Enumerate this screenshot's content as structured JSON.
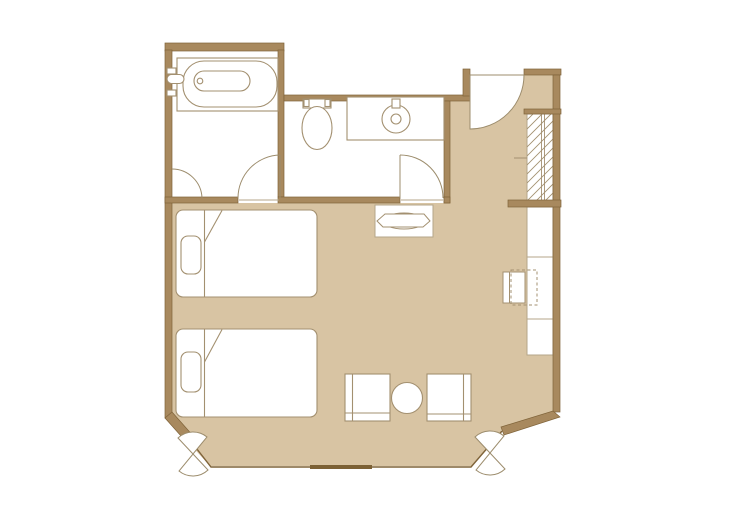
{
  "plan": {
    "name": "hotel-twin-room-floor-plan",
    "colors": {
      "background": "#ffffff",
      "floor": "#d8c4a3",
      "wall": "#a8895e",
      "wall_edge": "#7f6339",
      "fixture_line": "#a39070",
      "light_line": "#b5a689",
      "door_line": "#9c8c6c",
      "window_bar": "#7c6135",
      "white": "#ffffff"
    },
    "rooms": [
      {
        "name": "bathroom"
      },
      {
        "name": "toilet-washroom"
      },
      {
        "name": "entry-hall"
      },
      {
        "name": "closet"
      },
      {
        "name": "bedroom-living-area"
      }
    ],
    "furniture": [
      "bathtub",
      "bath-faucet",
      "toilet",
      "washbasin-counter",
      "round-sink",
      "luggage-bench",
      "closet-hanger-rail",
      "desk-counter",
      "desk-chair",
      "twin-bed-1",
      "twin-bed-2",
      "pillow-1",
      "pillow-2",
      "lounge-chair-left",
      "lounge-chair-right",
      "round-table"
    ],
    "openings": [
      "entrance-door",
      "bathroom-door",
      "washroom-door",
      "window-wall",
      "curtain-left",
      "curtain-right"
    ]
  }
}
